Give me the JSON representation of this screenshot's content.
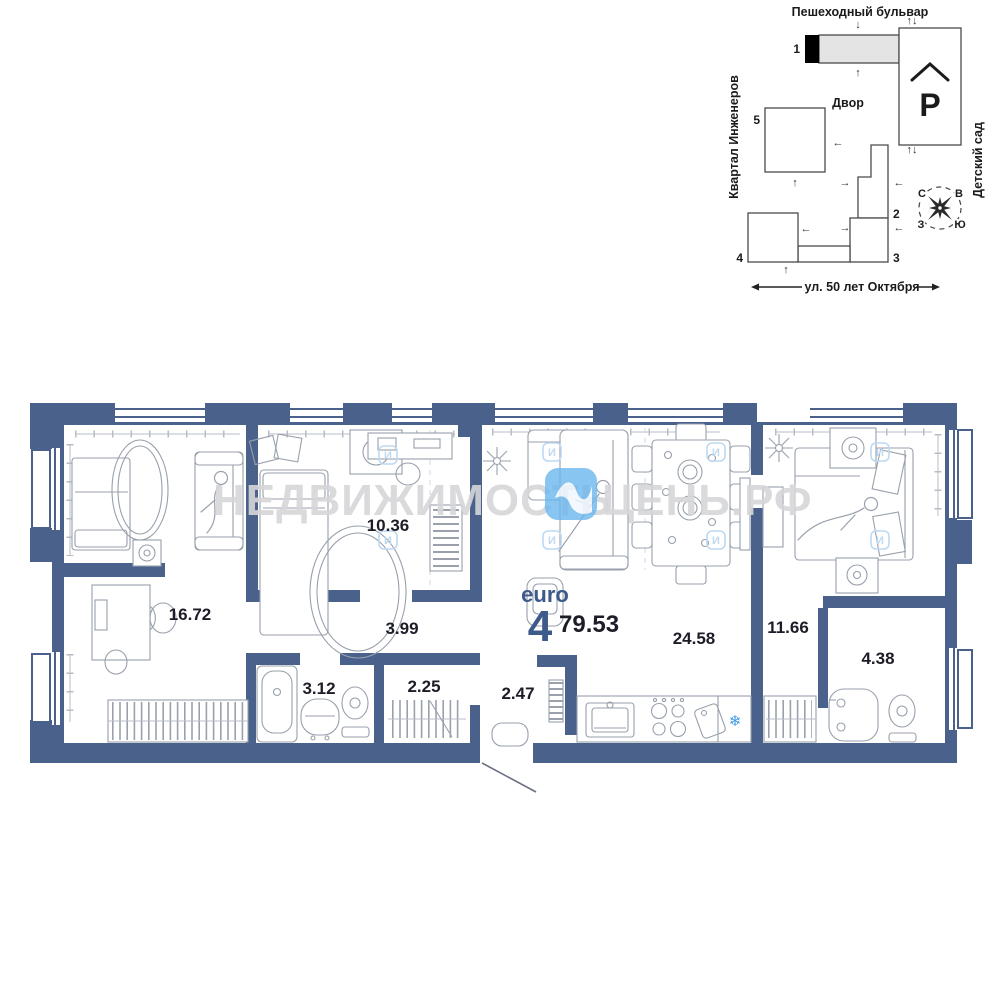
{
  "watermark": {
    "text_left": "НЕДВИЖИМОСТЬ",
    "text_right": "ЦЕНЬ.РФ",
    "tile_glyph": "И"
  },
  "site_plan": {
    "street_top": "Пешеходный бульвар",
    "street_left": "Квартал Инженеров",
    "street_right": "Детский сад",
    "street_bottom": "ул. 50 лет Октября",
    "courtyard": "Двор",
    "parking": "Р",
    "buildings": [
      "1",
      "2",
      "3",
      "4",
      "5"
    ],
    "compass": {
      "north": "С",
      "east": "В",
      "west": "З",
      "south": "Ю"
    },
    "glyphs": {
      "up": "↑",
      "down": "↓",
      "left": "←",
      "right": "→",
      "updown": "↑↓"
    }
  },
  "apartment": {
    "layout_type": "euro",
    "rooms_count": "4",
    "total_area": "79.53",
    "room_areas": {
      "living": "16.72",
      "bedroom2": "10.36",
      "corridor": "3.99",
      "bathroom1": "3.12",
      "wardrobe": "2.25",
      "hall": "2.47",
      "kitchen_living": "24.58",
      "bedroom3": "11.66",
      "bathroom2": "4.38"
    }
  },
  "icons": {
    "fridge_snowflake": "❄"
  },
  "colors": {
    "wall": "#4a618c",
    "accent_text": "#3d5a8a",
    "area_text": "#1d1d28",
    "furniture_stroke": "#98a0ac",
    "watermark_gray": "#d6d6da",
    "watermark_blue": "#6cb7ee",
    "snowflake_blue": "#3f9ae0",
    "site_outline": "#4a4a4a",
    "building_fill": "#e4e4e4"
  }
}
